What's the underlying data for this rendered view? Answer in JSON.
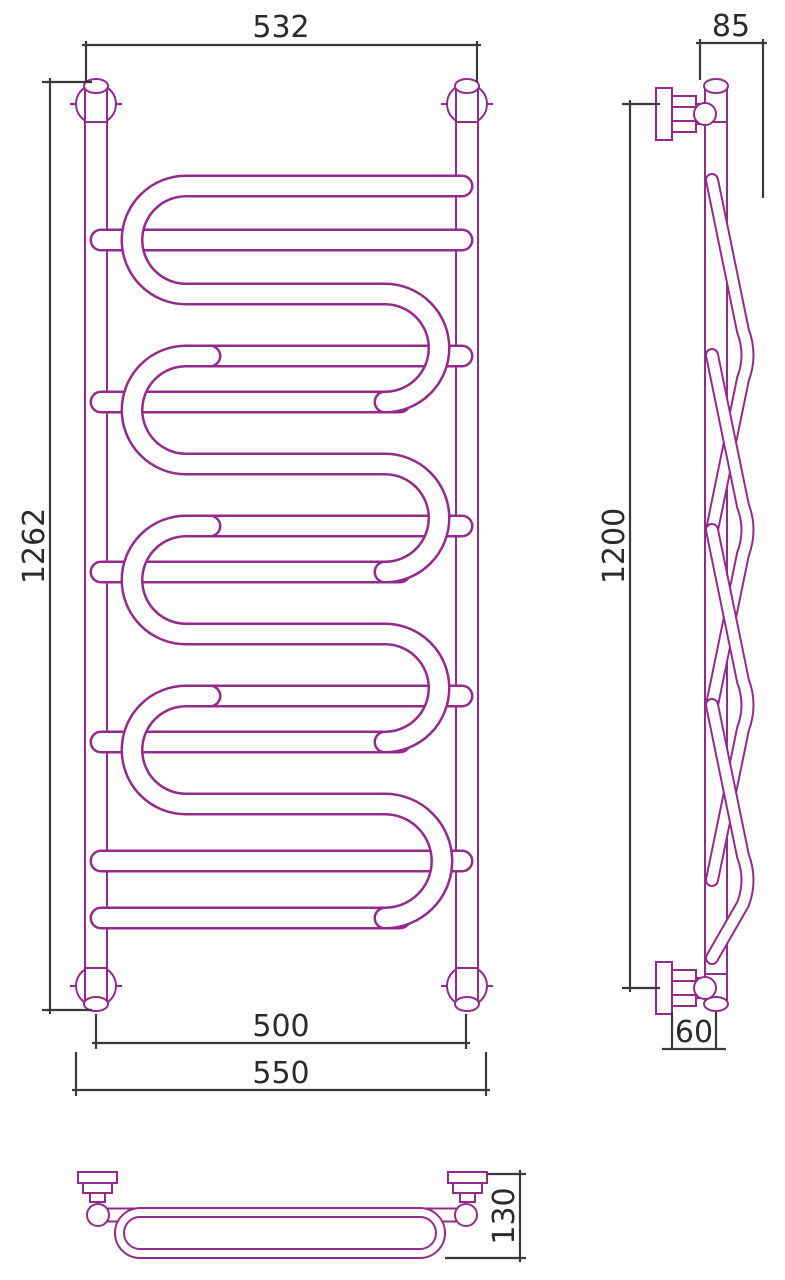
{
  "document": {
    "type": "technical-dimension-drawing",
    "subject": "ladder-serpentine-towel-rail-radiator",
    "views": [
      "front",
      "side",
      "plan"
    ]
  },
  "front_view": {
    "dim_width_top": "532",
    "dim_height": "1262",
    "dim_width_inner": "500",
    "dim_width_outer": "550"
  },
  "side_view": {
    "dim_depth_top": "85",
    "dim_height": "1200",
    "dim_wall_offset": "60"
  },
  "plan_view": {
    "dim_depth": "130"
  },
  "colors": {
    "product_outline": "#942B8C",
    "dimension_lines": "#3a3a3a",
    "dimension_text": "#2b2b2b",
    "background": "#ffffff"
  }
}
